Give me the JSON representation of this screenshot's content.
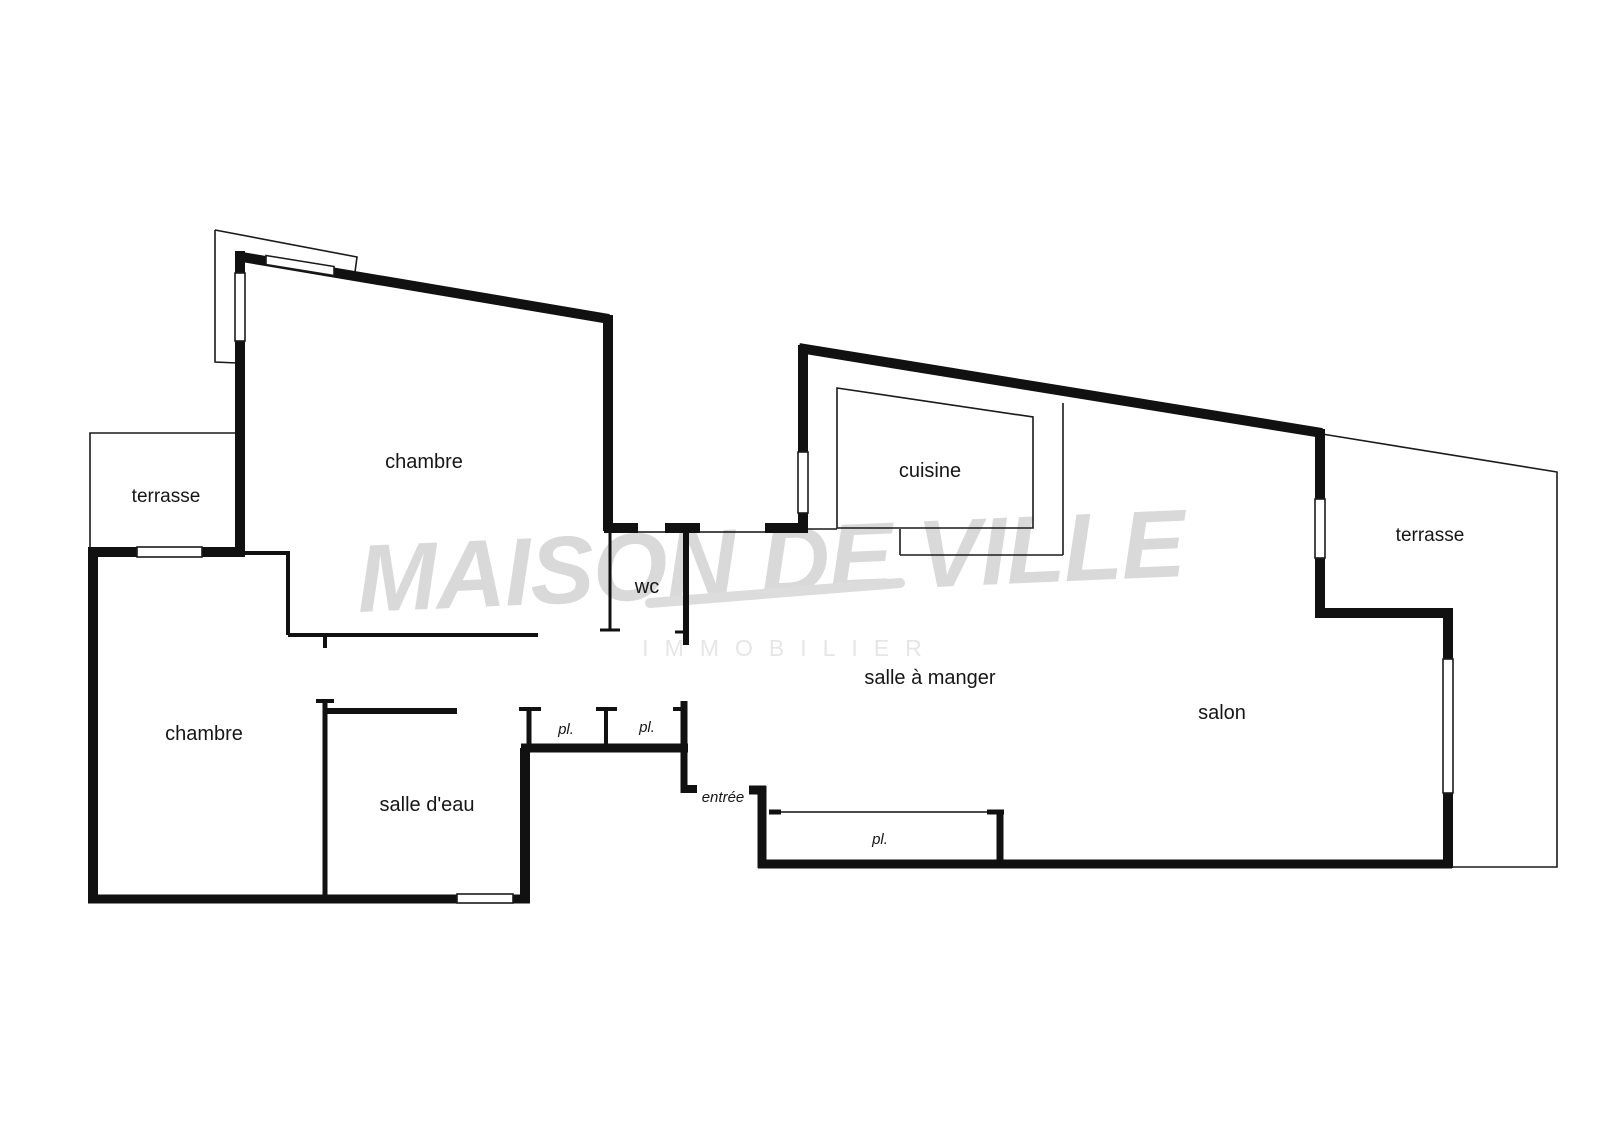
{
  "document": {
    "type": "real-estate floor plan",
    "language": "fr"
  },
  "watermark": {
    "line1": "MAISON DE VILLE",
    "line2": "IMMOBILIER"
  },
  "rooms": {
    "terrasse_upper_left": "terrasse",
    "chambre_top": "chambre",
    "chambre_bottom": "chambre",
    "wc": "wc",
    "cuisine": "cuisine",
    "salle_a_manger": "salle à manger",
    "salon": "salon",
    "salle_deau": "salle d'eau",
    "terrasse_right": "terrasse",
    "placard_small_left": "pl.",
    "placard_small_right": "pl.",
    "placard_large": "pl.",
    "entree": "entrée"
  },
  "colors": {
    "wall": "#111111",
    "thin_line": "#1a1a1a",
    "watermark_main": "#d9d9d9",
    "watermark_sub": "#e6e6e6",
    "background": "#ffffff"
  }
}
